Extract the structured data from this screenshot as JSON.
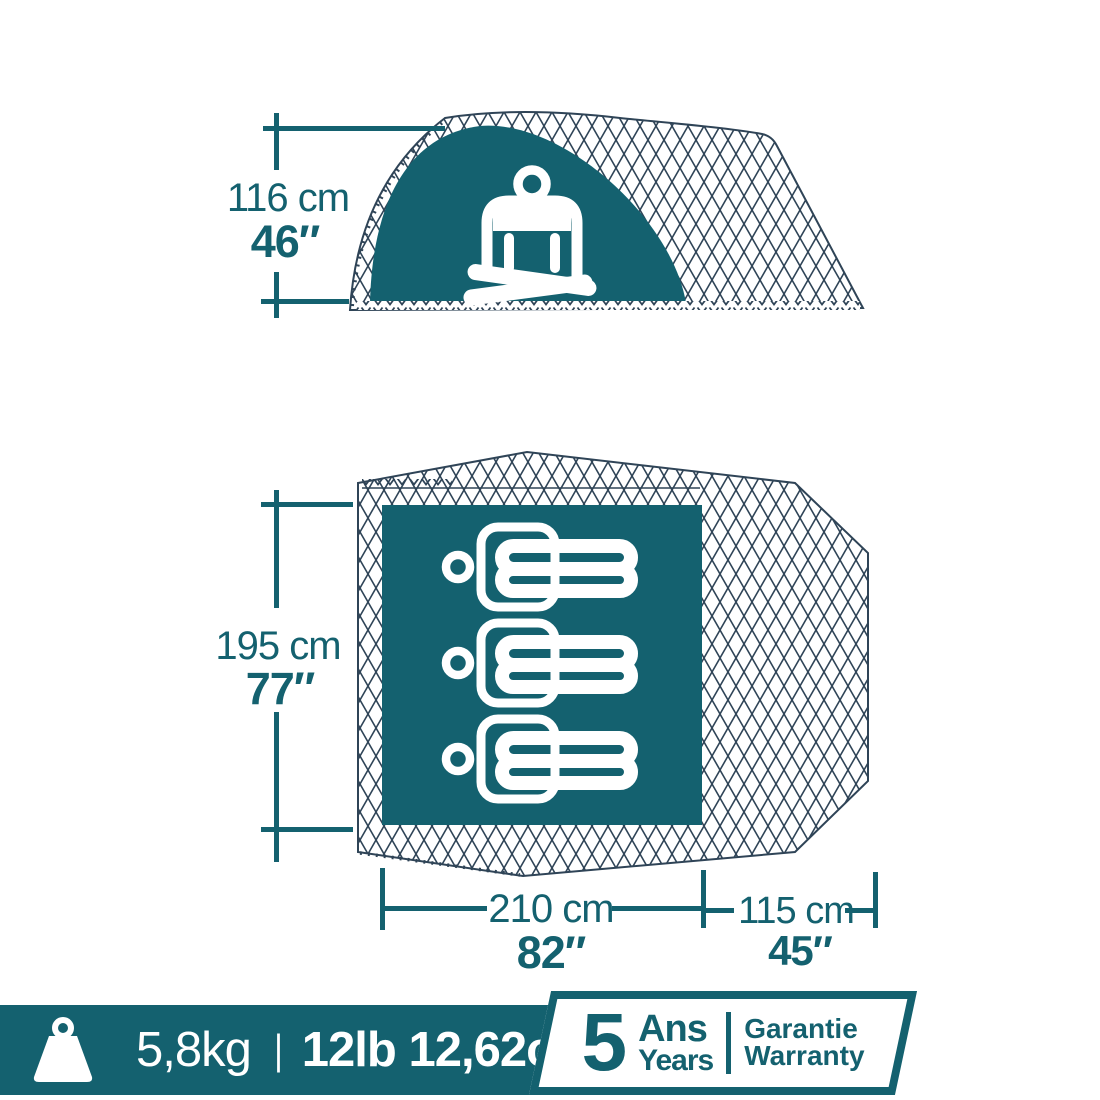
{
  "colors": {
    "teal": "#14616F",
    "mesh_line": "#2F4457",
    "white": "#FFFFFF"
  },
  "side_view": {
    "height_cm": "116 cm",
    "height_in": "46″",
    "icon": "sitting-person-icon"
  },
  "floor_plan": {
    "depth_cm": "195 cm",
    "depth_in": "77″",
    "length_cm": "210 cm",
    "length_in": "82″",
    "vestibule_cm": "115 cm",
    "vestibule_in": "45″",
    "icon": "sleeping-person-icon",
    "sleeper_count": 3
  },
  "footer": {
    "icon": "weight-icon",
    "weight_metric": "5,8kg",
    "separator": "|",
    "weight_imperial": "12lb 12,62oz",
    "warranty": {
      "number": "5",
      "duration_fr": "Ans",
      "duration_en": "Years",
      "label_fr": "Garantie",
      "label_en": "Warranty"
    }
  }
}
